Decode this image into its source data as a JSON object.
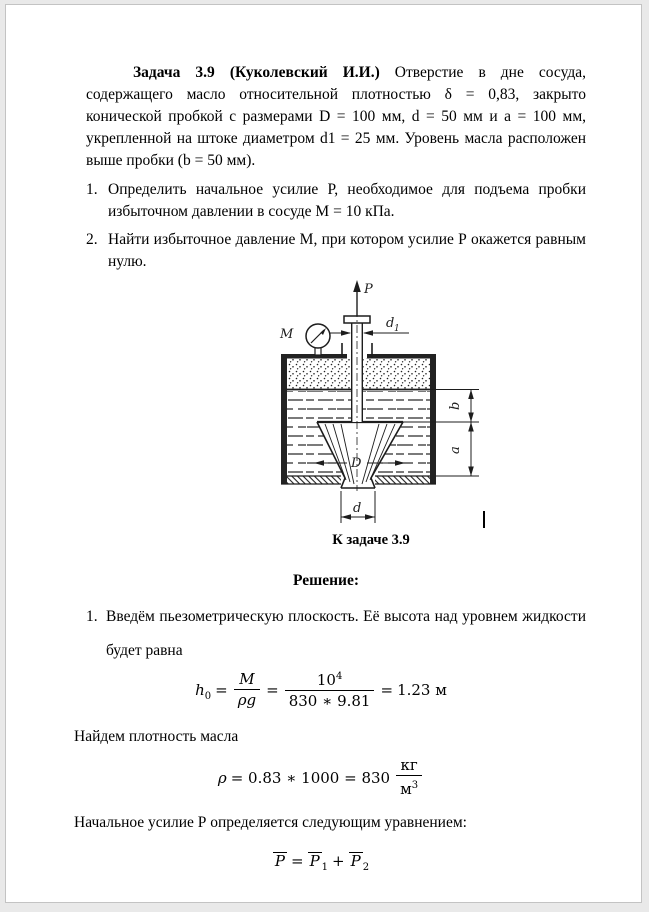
{
  "problem": {
    "title_bold": "Задача 3.9 (Куколевский И.И.)",
    "intro_rest": " Отверстие в дне сосуда, содержащего масло относительной плотностью δ = 0,83, закрыто конической пробкой с размерами D = 100 мм, d = 50 мм и а = 100 мм, укрепленной на штоке диаметром d1 = 25 мм. Уровень масла расположен выше пробки (b = 50 мм).",
    "tasks": [
      {
        "num": "1.",
        "text": "Определить начальное усилие Р, необходимое для подъема пробки избыточном давлении в сосуде М = 10 кПа."
      },
      {
        "num": "2.",
        "text": "Найти избыточное давление М, при котором усилие Р окажется равным нулю."
      }
    ]
  },
  "figure": {
    "caption": "К задаче 3.9",
    "labels": {
      "force": "P",
      "gauge": "M",
      "rod_dia_base": "d",
      "rod_dia_sub": "1",
      "cone_top_dia": "D",
      "cone_bottom_dia": "d",
      "depth_b": "b",
      "cone_height_a": "a"
    }
  },
  "solution": {
    "heading": "Решение:",
    "step1_num": "1.",
    "step1_text": "Введём пьезометрическую плоскость. Её высота над уровнем жидкости будет равна",
    "f1": {
      "lhs": "h",
      "lhs_sub": "0",
      "eq1": "=",
      "frac1_num": "M",
      "frac1_den": "ρg",
      "eq2": "=",
      "frac2_num_base": "10",
      "frac2_num_sup": "4",
      "frac2_den": "830 ∗ 9.81",
      "eq3": "=",
      "result": "1.23 м"
    },
    "density_text": "Найдем плотность масла",
    "f2": {
      "lhs": "ρ",
      "mid": "= 0.83 ∗ 1000 = 830",
      "unit_num": "кг",
      "unit_den_base": "м",
      "unit_den_sup": "3"
    },
    "force_text": "Начальное усилие Р определяется следующим уравнением:",
    "f3": {
      "p": "P",
      "eq": "=",
      "p1": "P",
      "p1_sub": "1",
      "plus": "+",
      "p2": "P",
      "p2_sub": "2"
    }
  }
}
